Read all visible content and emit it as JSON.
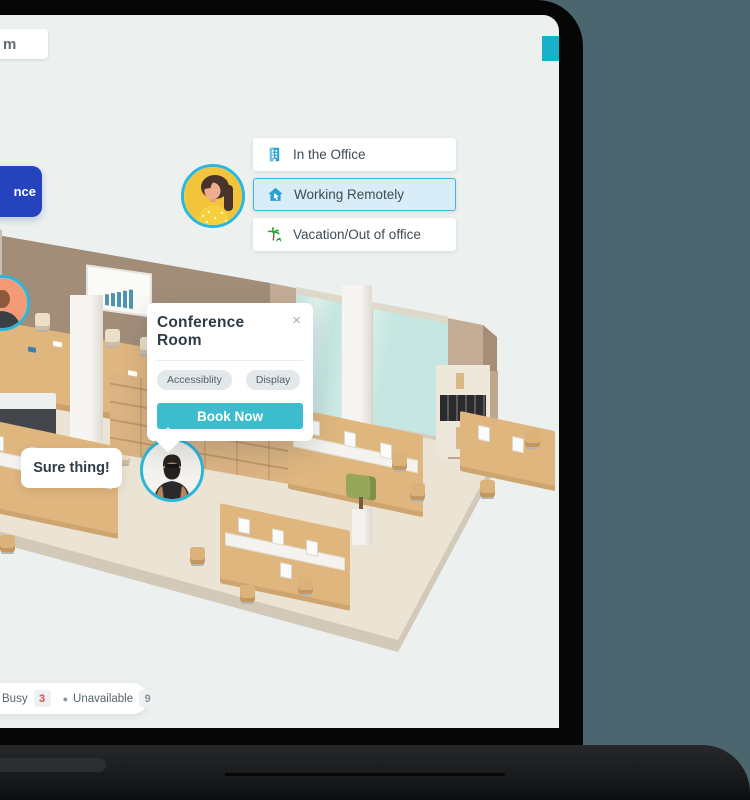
{
  "window": {
    "backdrop_color": "#4c6670",
    "device": "laptop"
  },
  "screen": {
    "background_color": "#ecf1f0"
  },
  "logo": {
    "text": "m"
  },
  "left_button": {
    "label": "nce",
    "color": "#2443bd"
  },
  "scrollbar": {
    "color": "#17b2ca"
  },
  "presence_menu": {
    "items": [
      {
        "label": "In the Office",
        "icon": "building-icon",
        "selected": false
      },
      {
        "label": "Working Remotely",
        "icon": "home-icon",
        "selected": true
      },
      {
        "label": "Vacation/Out of office",
        "icon": "palm-tree-icon",
        "selected": false
      }
    ],
    "highlight_color": "#d9edf9",
    "highlight_border": "#45b2e2"
  },
  "popup": {
    "title": "Conference Room",
    "close": "×",
    "tags": [
      "Accessiblity",
      "Display"
    ],
    "cta": "Book Now",
    "cta_color": "#3cbccc"
  },
  "chat_bubble": {
    "text": "Sure thing!"
  },
  "status_legend": {
    "items": [
      {
        "label": "Busy",
        "count": "3",
        "count_color": "#df4f48"
      },
      {
        "label": "Unavailable",
        "count": "9",
        "count_color": "#87939a",
        "dot": "●"
      }
    ]
  },
  "avatars": [
    {
      "id": "woman-yellow-avatar",
      "ring_color": "#2bb6dc"
    },
    {
      "id": "man-sunglasses-avatar",
      "ring_color": "#2bb6dc"
    },
    {
      "id": "orange-partial-avatar",
      "ring_color": "#2bb6dc"
    }
  ]
}
